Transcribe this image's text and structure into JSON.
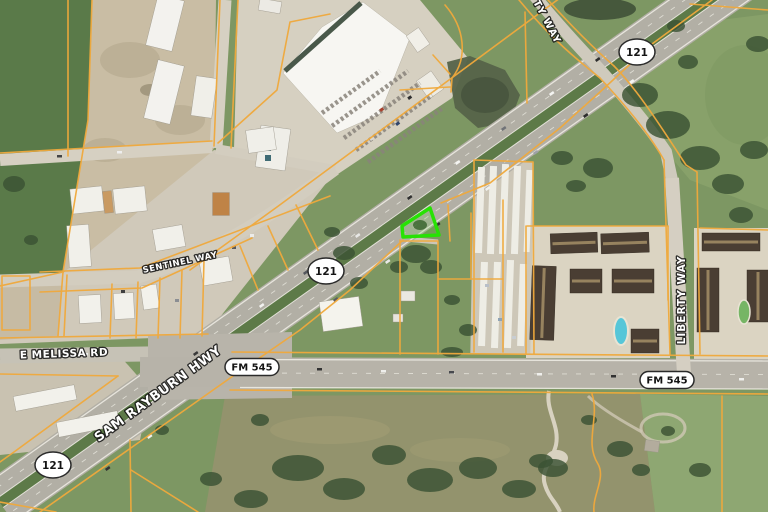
{
  "map": {
    "view": "aerial-satellite-with-parcel-overlay",
    "colors": {
      "parcel_line": "#f0a93c",
      "subject_parcel_outline": "#27e204",
      "label_fill": "#ffffff",
      "label_halo": "#101010"
    },
    "road_labels": [
      {
        "id": "e-melissa-rd",
        "text": "E MELISSA RD"
      },
      {
        "id": "sam-rayburn-hwy",
        "text": "SAM RAYBURN HWY"
      },
      {
        "id": "sentinel-way",
        "text": "SENTINEL WAY"
      },
      {
        "id": "ty-way",
        "text": "TY WAY"
      },
      {
        "id": "liberty-way",
        "text": "LIBERTY WAY"
      }
    ],
    "route_shields": [
      {
        "id": "sh-121-north",
        "text": "121"
      },
      {
        "id": "sh-121-central",
        "text": "121"
      },
      {
        "id": "sh-121-south",
        "text": "121"
      },
      {
        "id": "fm-545-west",
        "text": "FM 545"
      },
      {
        "id": "fm-545-east",
        "text": "FM 545"
      }
    ]
  }
}
